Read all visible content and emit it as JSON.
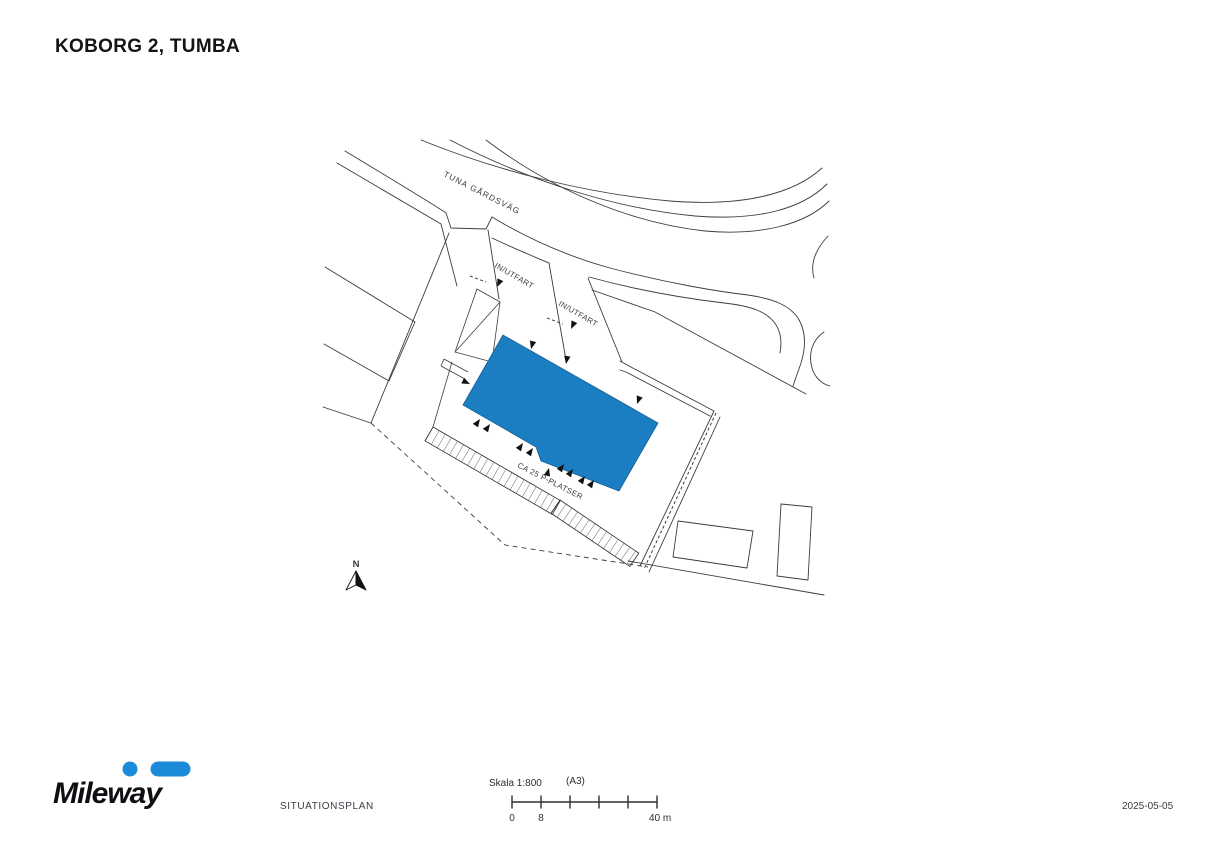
{
  "page": {
    "title": "KOBORG 2, TUMBA"
  },
  "plan": {
    "road_label": "TUNA GÅRDSVÄG",
    "entrance_label_1": "IN/UTFART",
    "entrance_label_2": "IN/UTFART",
    "parking_label": "CA 25 P-PLATSER",
    "north_label": "N",
    "building_color": "#1b7ec2",
    "line_color": "#3c3c3c",
    "icons": {
      "north_arrow": "compass-north-arrow",
      "door_marker": "filled-triangle-arrow"
    }
  },
  "footer": {
    "wordmark": "Mileway",
    "logo_color": "#1b8ad9",
    "doc_type": "SITUATIONSPLAN",
    "date": "2025-05-05",
    "scalebar": {
      "scale_label": "Skala 1:800",
      "paper_size": "(A3)",
      "tick_0": "0",
      "tick_8": "8",
      "tick_40": "40 m"
    }
  }
}
